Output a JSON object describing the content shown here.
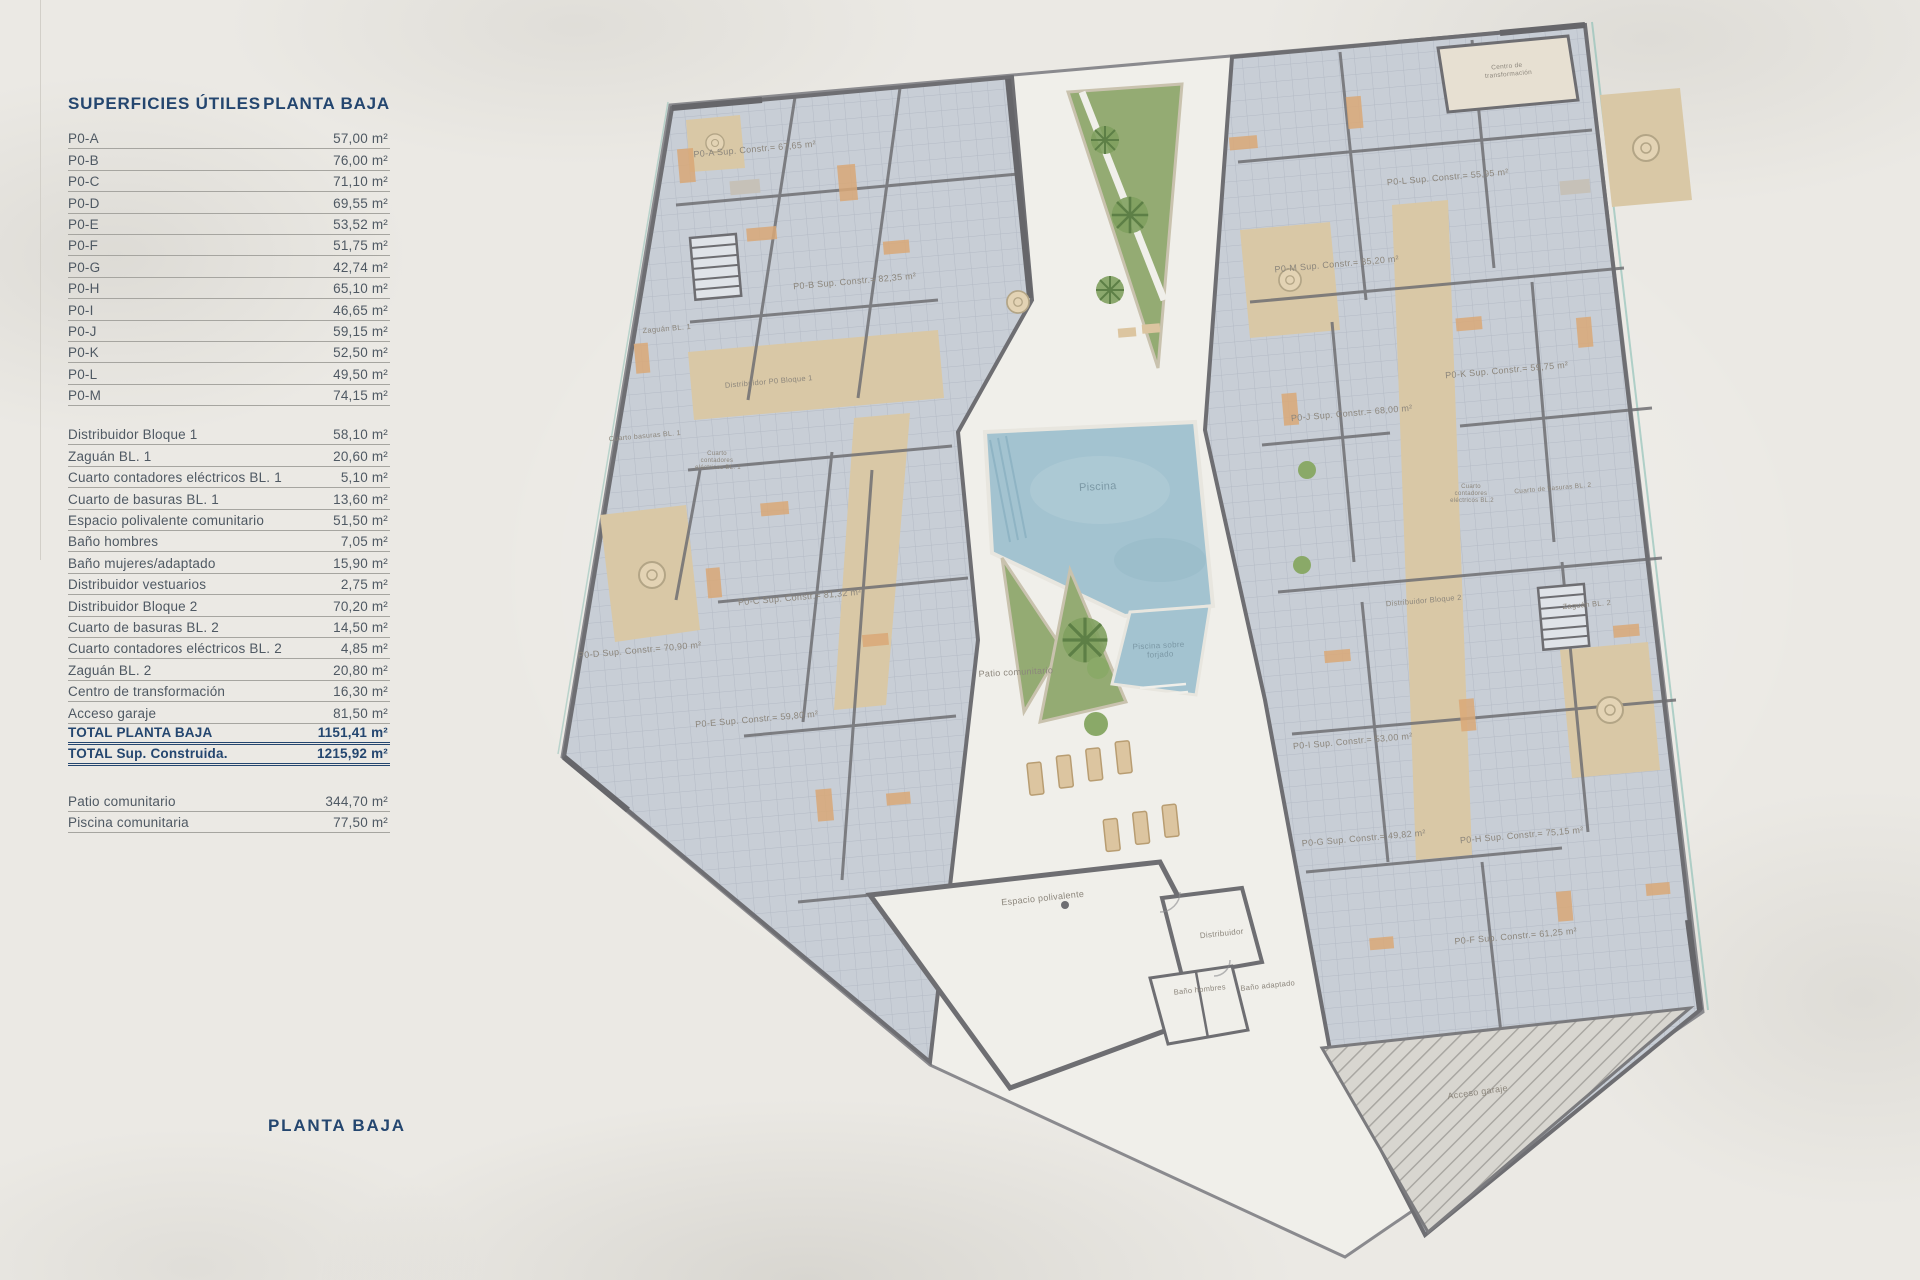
{
  "sidebar": {
    "header": {
      "title": "SUPERFICIES ÚTILES",
      "subtitle": "PLANTA BAJA"
    },
    "units": [
      {
        "label": "P0-A",
        "value": "57,00 m²"
      },
      {
        "label": "P0-B",
        "value": "76,00 m²"
      },
      {
        "label": "P0-C",
        "value": "71,10 m²"
      },
      {
        "label": "P0-D",
        "value": "69,55 m²"
      },
      {
        "label": "P0-E",
        "value": "53,52 m²"
      },
      {
        "label": "P0-F",
        "value": "51,75 m²"
      },
      {
        "label": "P0-G",
        "value": "42,74 m²"
      },
      {
        "label": "P0-H",
        "value": "65,10 m²"
      },
      {
        "label": "P0-I",
        "value": "46,65 m²"
      },
      {
        "label": "P0-J",
        "value": "59,15 m²"
      },
      {
        "label": "P0-K",
        "value": "52,50 m²"
      },
      {
        "label": "P0-L",
        "value": "49,50 m²"
      },
      {
        "label": "P0-M",
        "value": "74,15 m²"
      }
    ],
    "commons": [
      {
        "label": "Distribuidor Bloque 1",
        "value": "58,10 m²"
      },
      {
        "label": "Zaguán BL. 1",
        "value": "20,60 m²"
      },
      {
        "label": "Cuarto contadores eléctricos BL. 1",
        "value": "5,10 m²"
      },
      {
        "label": "Cuarto de basuras BL. 1",
        "value": "13,60 m²"
      },
      {
        "label": "Espacio polivalente comunitario",
        "value": "51,50 m²"
      },
      {
        "label": "Baño hombres",
        "value": "7,05 m²"
      },
      {
        "label": "Baño mujeres/adaptado",
        "value": "15,90 m²"
      },
      {
        "label": "Distribuidor vestuarios",
        "value": "2,75 m²"
      },
      {
        "label": "Distribuidor Bloque 2",
        "value": "70,20 m²"
      },
      {
        "label": "Cuarto de basuras BL. 2",
        "value": "14,50 m²"
      },
      {
        "label": "Cuarto contadores eléctricos BL. 2",
        "value": "4,85 m²"
      },
      {
        "label": "Zaguán BL. 2",
        "value": "20,80 m²"
      },
      {
        "label": "Centro de transformación",
        "value": "16,30 m²"
      },
      {
        "label": "Acceso garaje",
        "value": "81,50 m²"
      }
    ],
    "totals": [
      {
        "label": "TOTAL PLANTA BAJA",
        "value": "1151,41 m²"
      },
      {
        "label": "TOTAL Sup. Construida.",
        "value": "1215,92 m²"
      }
    ],
    "outdoor": [
      {
        "label": "Patio comunitario",
        "value": "344,70 m²"
      },
      {
        "label": "Piscina comunitaria",
        "value": "77,50 m²"
      }
    ],
    "footer_title": "PLANTA BAJA"
  },
  "plan": {
    "unit_labels": [
      "P0-A Sup. Constr.= 67,65 m²",
      "P0-B Sup. Constr.= 82,35 m²",
      "P0-C Sup. Constr.= 81,32 m²",
      "P0-D Sup. Constr.= 70,90 m²",
      "P0-E Sup. Constr.= 59,80 m²",
      "P0-F Sup. Constr.= 61,25 m²",
      "P0-G Sup. Constr.= 49,82 m²",
      "P0-H Sup. Constr.= 75,15 m²",
      "P0-I Sup. Constr.= 53,00 m²",
      "P0-J Sup. Constr.= 68,00 m²",
      "P0-K Sup. Constr.= 59,75 m²",
      "P0-L Sup. Constr.= 55,95 m²",
      "P0-M Sup. Constr.= 85,20 m²"
    ],
    "labels": {
      "piscina": "Piscina",
      "piscina_sobre_forjado": [
        "Piscina sobre",
        "forjado"
      ],
      "patio_comunitario": "Patio comunitario",
      "espacio_polivalente": "Espacio polivalente",
      "distribuidor": "Distribuidor",
      "bano_hombres": "Baño hombres",
      "bano_adaptado": "Baño adaptado",
      "acceso_garaje": "Acceso garaje",
      "zaguan_bl1": "Zaguán BL. 1",
      "distribuidor_p0_bloque1": "Distribuidor P0 Bloque 1",
      "cuarto_basuras_bl1": "Cuarto basuras BL. 1",
      "cuarto_contadores_bl1": [
        "Cuarto",
        "contadores",
        "eléctricos BL. 1"
      ],
      "distribuidor_bloque2": "Distribuidor Bloque 2",
      "zaguan_bl2": "Zaguán BL. 2",
      "cuarto_basuras_bl2": "Cuarto de basuras BL. 2",
      "cuarto_contadores_bl2": [
        "Cuarto",
        "contadores",
        "eléctricos BL.2"
      ],
      "centro_transformacion": [
        "Centro de",
        "transformación"
      ]
    },
    "colors": {
      "pool": "#a3c3d0",
      "greenery": "#94ab73",
      "terrace_tan": "#d9c8a6",
      "room_gray": "#c8ced6",
      "wall": "#6e6e72",
      "path_white": "#f0efea",
      "label_gray": "#8c867c",
      "accent_navy": "#24466f"
    }
  }
}
